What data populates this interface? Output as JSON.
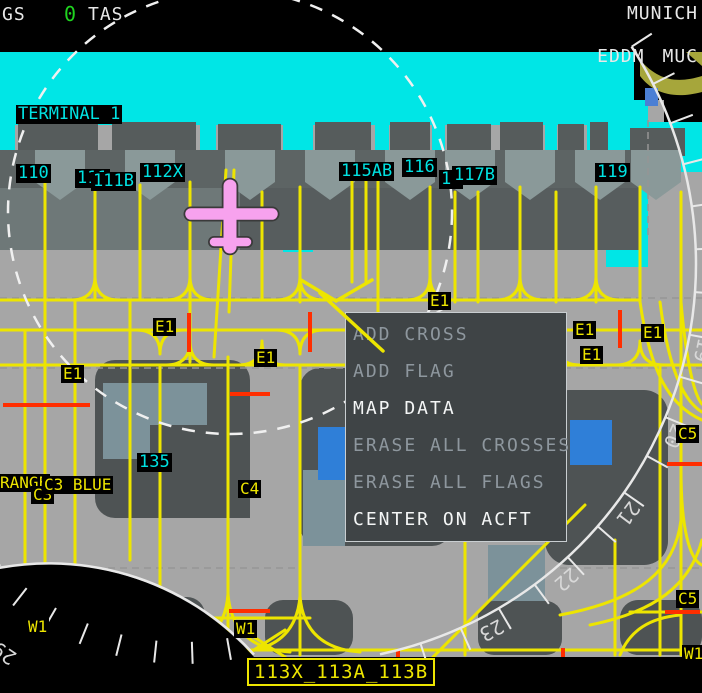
{
  "header": {
    "gs_label": "GS",
    "gs_value": "0",
    "tas_label": "TAS",
    "airport_name": "MUNICH",
    "airport_icao": "EDDM",
    "airport_iata": "MUC"
  },
  "context_menu": {
    "items": [
      {
        "label": "ADD CROSS",
        "enabled": false
      },
      {
        "label": "ADD FLAG",
        "enabled": false
      },
      {
        "label": "MAP DATA",
        "enabled": true
      },
      {
        "label": "ERASE ALL CROSSES",
        "enabled": false
      },
      {
        "label": "ERASE ALL FLAGS",
        "enabled": false
      },
      {
        "label": "CENTER ON ACFT",
        "enabled": true
      }
    ]
  },
  "map": {
    "terminal_label": {
      "text": "TERMINAL 1",
      "x": 16,
      "y": 105
    },
    "gate_labels": [
      {
        "text": "110",
        "x": 16,
        "y": 164
      },
      {
        "text": "111",
        "x": 75,
        "y": 169
      },
      {
        "text": "111B",
        "x": 91,
        "y": 172
      },
      {
        "text": "112X",
        "x": 140,
        "y": 163
      },
      {
        "text": "115AB",
        "x": 339,
        "y": 162
      },
      {
        "text": "116",
        "x": 402,
        "y": 158
      },
      {
        "text": "11",
        "x": 439,
        "y": 170
      },
      {
        "text": "117B",
        "x": 452,
        "y": 166
      },
      {
        "text": "119",
        "x": 595,
        "y": 163
      },
      {
        "text": "135",
        "x": 137,
        "y": 453
      }
    ],
    "taxiway_labels": [
      {
        "text": "E1",
        "x": 153,
        "y": 318
      },
      {
        "text": "E1",
        "x": 61,
        "y": 365
      },
      {
        "text": "E1",
        "x": 254,
        "y": 349
      },
      {
        "text": "E1",
        "x": 428,
        "y": 292
      },
      {
        "text": "E1",
        "x": 573,
        "y": 321
      },
      {
        "text": "E1",
        "x": 641,
        "y": 324
      },
      {
        "text": "E1",
        "x": 580,
        "y": 346
      },
      {
        "text": "RANGE",
        "x": -2,
        "y": 474
      },
      {
        "text": "C3",
        "x": 31,
        "y": 486
      },
      {
        "text": "C3 BLUE",
        "x": 42,
        "y": 476
      },
      {
        "text": "C4",
        "x": 238,
        "y": 480
      },
      {
        "text": "C5",
        "x": 676,
        "y": 425
      },
      {
        "text": "C5",
        "x": 676,
        "y": 590
      },
      {
        "text": "W1",
        "x": 26,
        "y": 618
      },
      {
        "text": "W1",
        "x": 234,
        "y": 620
      },
      {
        "text": "W1",
        "x": 682,
        "y": 645
      }
    ],
    "stand_selection": {
      "text": "113X_113A_113B",
      "x": 247,
      "y": 658
    },
    "compass_headings": [
      {
        "text": "19",
        "angle": 102
      },
      {
        "text": "20",
        "angle": 114.5
      },
      {
        "text": "21",
        "angle": 127
      },
      {
        "text": "22",
        "angle": 139.5
      },
      {
        "text": "23",
        "angle": 152
      }
    ],
    "compass_heading_secondary": {
      "text": "29",
      "angle": 214
    },
    "symbols": {
      "ownship": "aircraft-silhouette",
      "range_ring": "dashed-circle",
      "compass_arc": "runway-heading-scale"
    }
  },
  "colors": {
    "apron": "#A6A6A6",
    "terminal_cyan": "#00E6E6",
    "taxiline_yellow": "#EDE500",
    "stopbar_red": "#FF2E00",
    "ownship_pink": "#F7A2EE",
    "building_dark": "#4E5354",
    "menu_bg": "#3F4446",
    "enabled_text": "#F4F6F6",
    "disabled_text": "#8E979E",
    "gs_green": "#1FD41F"
  }
}
